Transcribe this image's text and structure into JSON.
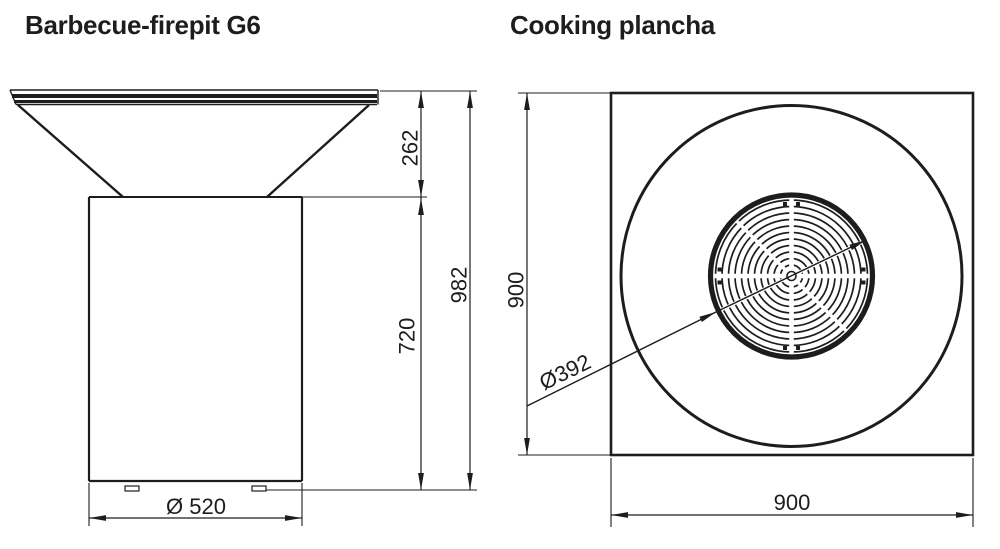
{
  "canvas": {
    "background": "#ffffff",
    "line_color": "#1d1d1b"
  },
  "left_drawing": {
    "title": "Barbecue-firepit G6",
    "view": "side elevation",
    "dimensions": {
      "bowl_height": "262",
      "base_height": "720",
      "total_height": "982",
      "base_diameter": "Ø 520"
    }
  },
  "right_drawing": {
    "title": "Cooking plancha",
    "view": "top view",
    "dimensions": {
      "depth": "900",
      "width": "900",
      "grate_diameter": "Ø392"
    }
  }
}
